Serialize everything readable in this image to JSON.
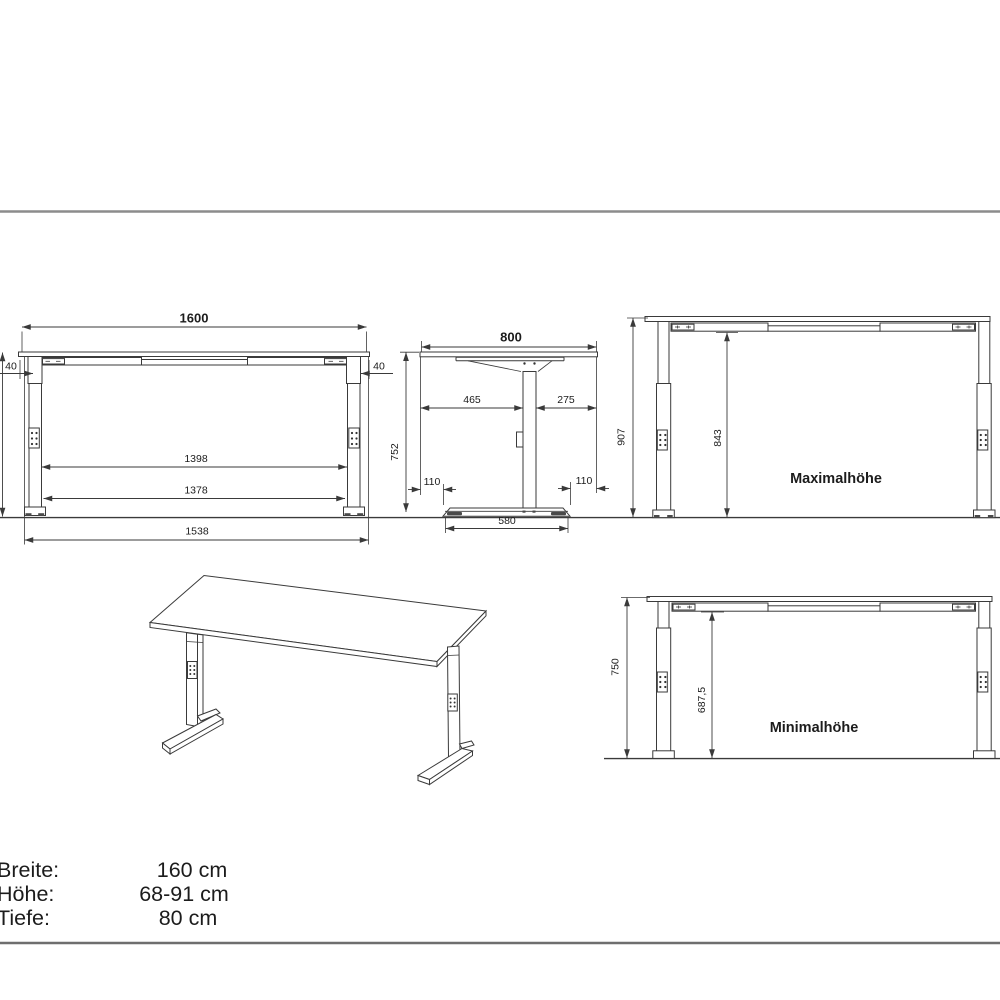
{
  "front_view": {
    "width": "1600",
    "overhang_left": "40",
    "overhang_right": "40",
    "inner_top": "1398",
    "inner_bottom": "1378",
    "foot_span": "1538",
    "height": "752"
  },
  "side_view": {
    "depth": "800",
    "front_offset": "465",
    "back_offset": "275",
    "height": "752",
    "foot_inset_left": "110",
    "foot_inset_right": "110",
    "foot_length": "580"
  },
  "max_view": {
    "total_height": "907",
    "frame_height": "843",
    "label": "Maximalhöhe"
  },
  "min_view": {
    "total_height": "750",
    "frame_height": "687,5",
    "label": "Minimalhöhe"
  },
  "specs": {
    "rows": [
      {
        "label": "Breite:",
        "value": "160 cm"
      },
      {
        "label": "Höhe:",
        "value": "68-91 cm"
      },
      {
        "label": "Tiefe:",
        "value": "80 cm"
      }
    ]
  }
}
